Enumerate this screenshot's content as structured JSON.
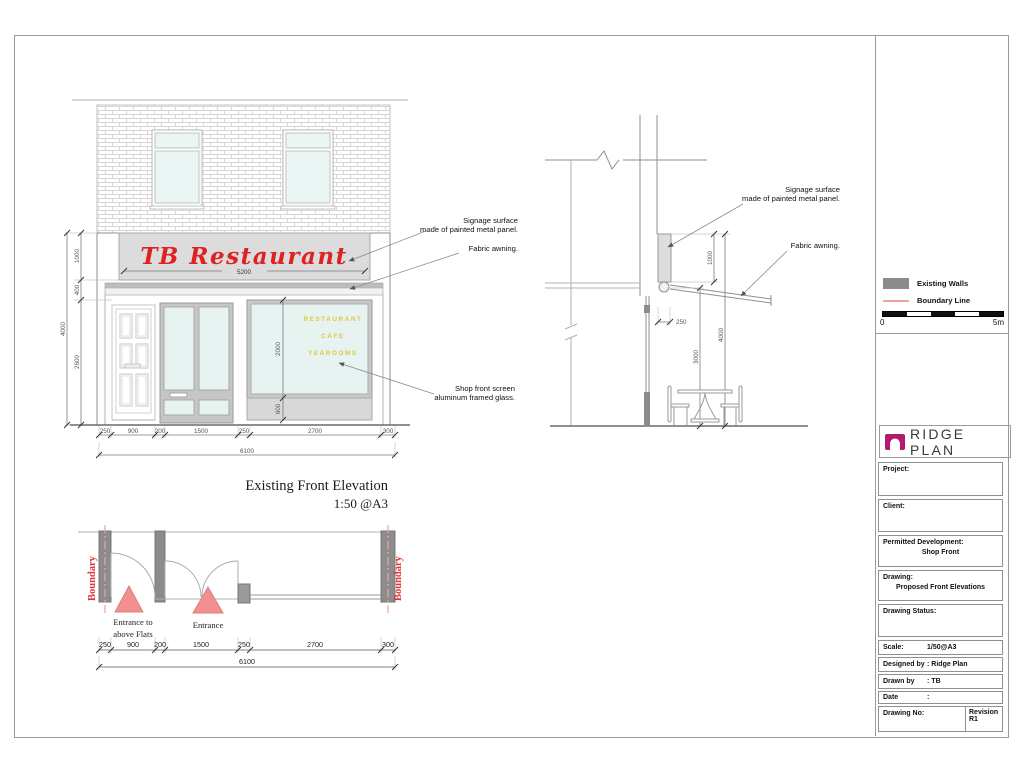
{
  "colors": {
    "signage_red": "#e02121",
    "window_text_yellow": "#ddc93a",
    "boundary_red": "#e23535",
    "boundary_line_pink": "#f4a0a0",
    "wall_gray": "#8c8c8c",
    "pier_gray": "#9a9a9a",
    "triangle_pink": "#f29090",
    "logo_magenta": "#b5186d",
    "signage_panel_gray": "#dcdcdc"
  },
  "elevation": {
    "title_line1": "Existing Front Elevation",
    "title_line2": "1:50 @A3",
    "signage_text": "TB Restaurant",
    "signage_width": "5200",
    "window_text": [
      "RESTAURANT",
      "CAFE",
      "TEAROOMS"
    ],
    "annotation_signage_1": "Signage surface",
    "annotation_signage_2": "made of painted metal panel.",
    "annotation_awning": "Fabric awning.",
    "annotation_glass_1": "Shop front screen",
    "annotation_glass_2": "aluminum framed glass.",
    "dims_vertical": [
      "1000",
      "400",
      "2600"
    ],
    "dim_vertical_total": "4000",
    "dims_window": [
      "2000",
      "600"
    ],
    "dims_horizontal": [
      "250",
      "900",
      "200",
      "1500",
      "250",
      "2700",
      "300"
    ],
    "dim_horizontal_total": "6100"
  },
  "section": {
    "annotation_signage_1": "Signage surface",
    "annotation_signage_2": "made of painted metal panel.",
    "annotation_awning": "Fabric awning.",
    "dim_signage_height": "1000",
    "dim_offset": "250",
    "dim_clear_height": "3000",
    "dim_total_height": "4000"
  },
  "plan": {
    "boundary_label_left": "Boundary",
    "boundary_label_right": "Boundary",
    "entrance_flats_line1": "Entrance to",
    "entrance_flats_line2": "above Flats",
    "entrance_label": "Entrance",
    "dims_horizontal": [
      "250",
      "900",
      "200",
      "1500",
      "250",
      "2700",
      "300"
    ],
    "dim_horizontal_total": "6100"
  },
  "legend": {
    "existing_walls": "Existing Walls",
    "boundary_line": "Boundary Line",
    "scale_zero": "0",
    "scale_max": "5m"
  },
  "brand": {
    "name": "RIDGE PLAN"
  },
  "titleblock": {
    "project_label": "Project:",
    "client_label": "Client:",
    "permitted_label": "Permitted Development:",
    "permitted_value": "Shop Front",
    "drawing_label": "Drawing:",
    "drawing_value": "Proposed Front Elevations",
    "status_label": "Drawing Status:",
    "scale_label": "Scale:",
    "scale_value": "1/50@A3",
    "designed_label": "Designed by",
    "drawn_label": "Drawn by",
    "date_label": "Date",
    "colon": ":",
    "designed_value": "Ridge Plan",
    "drawn_value": "TB",
    "drawingno_label": "Drawing No:",
    "revision_label": "Revision",
    "revision_value": "R1"
  }
}
